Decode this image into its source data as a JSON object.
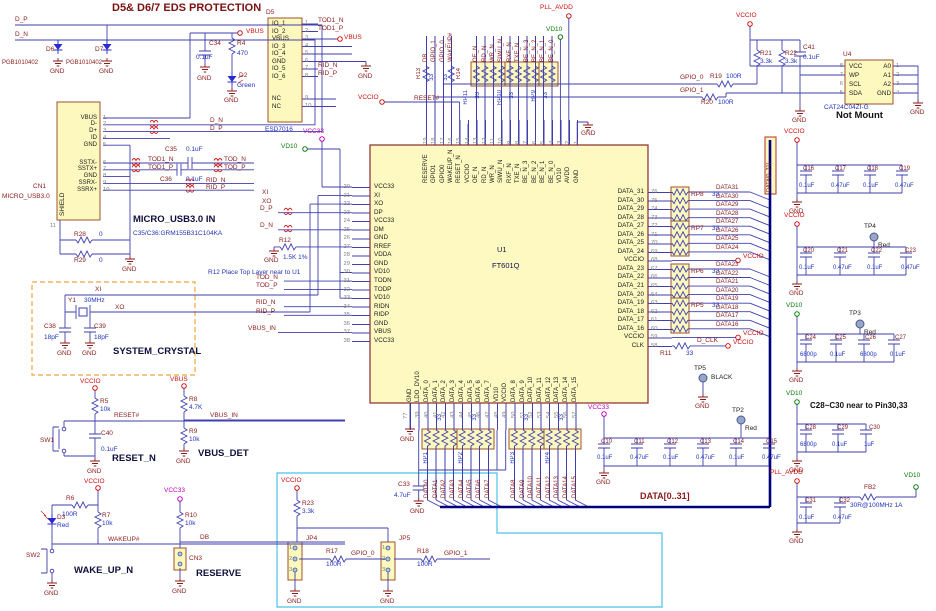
{
  "common": {
    "gnd": "GND",
    "vbus": "VBUS",
    "vccio": "VCCIO",
    "vcc33": "VCC33",
    "vd10": "VD10",
    "pll": "PLL_AVDD"
  },
  "esd": {
    "title": "D5& D6/7 EDS PROTECTION",
    "dp": "D_P",
    "dn": "D_N",
    "d6": "D6",
    "d7": "D7",
    "part": "PGB1010402",
    "c34": "C34",
    "c34v": "0.1uF",
    "r4": "R4",
    "r4v": "470",
    "d2": "D2",
    "d2v": "Green"
  },
  "d5": {
    "ref": "D5",
    "part": "ESD7016",
    "pins": [
      "IO_1",
      "IO_2",
      "VBUS",
      "IO_3",
      "IO_4",
      "GND",
      "IO_5",
      "IO_6"
    ],
    "nums": [
      "1",
      "2",
      "3",
      "4",
      "5",
      "6",
      "7",
      "8"
    ],
    "nc": [
      "NC",
      "NC"
    ],
    "ncnums": [
      "9",
      "10"
    ],
    "tod1n": "TOD1_N",
    "tod1p": "TOD1_P",
    "ridn": "RID_N",
    "ridp": "RID_P"
  },
  "usb": {
    "ref": "CN1",
    "name": "MICRO_USB3.0",
    "shield": "SHIELD",
    "shieldnum": "11",
    "pins1": [
      "VBUS",
      "D-",
      "D+",
      "ID",
      "GND"
    ],
    "nums1": [
      "1",
      "2",
      "3",
      "4",
      "5"
    ],
    "pins2": [
      "SSTX-",
      "SSTX+",
      "GND",
      "SSRX-",
      "SSRX+"
    ],
    "nums2": [
      "6",
      "7",
      "8",
      "9",
      "10"
    ],
    "dn": "D_N",
    "dp": "D_P",
    "tod1n": "TOD1_N",
    "tod1p": "TOD1_P",
    "todn": "TOD_N",
    "todp": "TOD_P",
    "ridn": "RID_N",
    "ridp": "RID_P",
    "c35": "C35",
    "c35v": "0.1uF",
    "c36": "C36",
    "c36v": "0.1uF",
    "r28": "R28",
    "r28v": "0",
    "r29": "R29",
    "r29v": "0",
    "title": "MICRO_USB3.0 IN",
    "note": "C35/C36:GRM155B31C104KA"
  },
  "xtal": {
    "xi": "XI",
    "xo": "XO",
    "y1": "Y1",
    "freq": "30MHz",
    "c38": "C38",
    "c38v": "18pF",
    "c39": "C39",
    "c39v": "18pF",
    "title": "SYSTEM_CRYSTAL"
  },
  "reset": {
    "r5": "R5",
    "r5v": "10k",
    "net": "RESET#",
    "sw": "SW1",
    "c40": "C40",
    "c40v": "0.1uF",
    "title": "RESET_N"
  },
  "vdet": {
    "r8": "R8",
    "r8v": "4.7K",
    "net": "VBUS_IN",
    "r9": "R9",
    "r9v": "10k",
    "title": "VBUS_DET"
  },
  "wake": {
    "r6": "R6",
    "r6v": "100R",
    "d3": "D3",
    "d3v": "Red",
    "r7": "R7",
    "r7v": "10k",
    "net": "WAKEUP#",
    "sw": "SW2",
    "title": "WAKE_UP_N"
  },
  "rsv": {
    "r10": "R10",
    "r10v": "10k",
    "net": "DB",
    "cn3": "CN3",
    "title": "RESERVE"
  },
  "jp": {
    "r23": "R23",
    "r23v": "3.3k",
    "jp4": "JP4",
    "r17": "R17",
    "r17v": "100R",
    "gpio0": "GPIO_0",
    "jp5": "JP5",
    "r18": "R18",
    "r18v": "100R",
    "gpio1": "GPIO_1",
    "nums": [
      "1",
      "2",
      "3"
    ]
  },
  "chip": {
    "ref": "U1",
    "part": "FT601Q",
    "left_pins": [
      "VCC33",
      "XI",
      "XO",
      "DP",
      "VCC33",
      "DM",
      "GND",
      "RREF",
      "VDDA",
      "GND",
      "VD10",
      "TODN",
      "TODP",
      "VD10",
      "RIDN",
      "RIDP",
      "GND",
      "VBUS",
      "VCC33"
    ],
    "left_nums": [
      "20",
      "21",
      "22",
      "23",
      "24",
      "25",
      "26",
      "27",
      "28",
      "29",
      "30",
      "31",
      "32",
      "33",
      "34",
      "35",
      "36",
      "37",
      "38"
    ],
    "right_pins": [
      "DATA_31",
      "DATA_30",
      "DATA_29",
      "DATA_28",
      "DATA_27",
      "DATA_26",
      "DATA_25",
      "DATA_24",
      "VCCIO",
      "DATA_23",
      "DATA_22",
      "DATA_21",
      "DATA_20",
      "DATA_19",
      "DATA_18",
      "DATA_17",
      "DATA_16",
      "VCCIO",
      "CLK"
    ],
    "right_nums": [
      "76",
      "75",
      "74",
      "73",
      "72",
      "71",
      "70",
      "69",
      "68",
      "67",
      "66",
      "65",
      "64",
      "63",
      "62",
      "61",
      "60",
      "59",
      "58"
    ],
    "top_pins": [
      "RESERVE",
      "GPIO1",
      "GPIO0",
      "WAKEUP_N",
      "RESET_N",
      "VCCIO",
      "OE_N",
      "RD_N",
      "WR_N",
      "SIWU_N",
      "RXF_N",
      "TXE_N",
      "BE_N_3",
      "BE_N_2",
      "BE_N_1",
      "BE_N_0",
      "VD10",
      "AVDD",
      "GND"
    ],
    "top_nums": [
      "19",
      "18",
      "17",
      "16",
      "15",
      "14",
      "13",
      "12",
      "11",
      "10",
      "9",
      "8",
      "7",
      "6",
      "5",
      "4",
      "3",
      "2",
      "1"
    ],
    "bottom_pins": [
      "GND",
      "LDO_DV10",
      "DATA_0",
      "DATA_1",
      "DATA_2",
      "DATA_3",
      "DATA_4",
      "DATA_5",
      "DATA_6",
      "DATA_7",
      "VD10",
      "VCCIO",
      "DATA_8",
      "DATA_9",
      "DATA_10",
      "DATA_11",
      "DATA_12",
      "DATA_13",
      "DATA_14",
      "DATA_15"
    ],
    "bottom_nums": [
      "39",
      "40",
      "41",
      "42",
      "43",
      "44",
      "45",
      "46",
      "47",
      "48",
      "49",
      "50",
      "51",
      "52",
      "53",
      "54",
      "55",
      "56",
      "57"
    ],
    "pad": "77"
  },
  "top": {
    "sigsa": [
      "DB",
      "GPIO_1",
      "GPIO_0",
      "WAKEUP#"
    ],
    "sigsb": [
      "OE_N",
      "RD_N",
      "WR_N",
      "SIWU_N",
      "RXF_N",
      "TXE_N",
      "BE_N_3",
      "BE_N_2",
      "BE_N_1",
      "BE_N_0"
    ],
    "r13": "R13",
    "r14": "R14",
    "v33": "33",
    "rp11": "RP11",
    "rp10": "RP10",
    "rp9": "RP9",
    "reset": "RESET#"
  },
  "left": {
    "xi": "XI",
    "xo": "XO",
    "dp": "D_P",
    "dn": "D_N",
    "r12": "R12",
    "r12v": "1.5K 1%",
    "note": "R12 Place Top Layer near to U1",
    "todn": "TOD_N",
    "todp": "TOD_P",
    "ridn": "RID_N",
    "ridp": "RID_P",
    "vbusin": "VBUS_IN"
  },
  "right": {
    "rp8": "RP8",
    "rp7": "RP7",
    "rp6": "RP6",
    "rp5": "RP5",
    "v33": "33",
    "hi": [
      "DATA31",
      "DATA30",
      "DATA29",
      "DATA28",
      "DATA27",
      "DATA26",
      "DATA25",
      "DATA24"
    ],
    "lo": [
      "DATA23",
      "DATA22",
      "DATA21",
      "DATA20",
      "DATA19",
      "DATA18",
      "DATA17",
      "DATA16"
    ],
    "r11": "R11",
    "r11v": "33",
    "dclk": "D_CLK",
    "bus": "DATA[0..31]"
  },
  "bot": {
    "rp1": "RP1",
    "rp2": "RP2",
    "rp3": "RP3",
    "rp4": "RP4",
    "v33": "33",
    "a": [
      "DATA0",
      "DATA1",
      "DATA2",
      "DATA3",
      "DATA4",
      "DATA5",
      "DATA6",
      "DATA7"
    ],
    "b": [
      "DATA8",
      "DATA9",
      "DATA10",
      "DATA11",
      "DATA12",
      "DATA13",
      "DATA14",
      "DATA15"
    ],
    "c33": "C33",
    "c33v": "4.7uF"
  },
  "banks": {
    "c10": {
      "refs": [
        "C10",
        "C11",
        "C12",
        "C13",
        "C14",
        "C15"
      ],
      "vals": [
        "0.1uF",
        "0.47uF",
        "0.1uF",
        "0.47uF",
        "0.1uF",
        "0.47uF"
      ]
    },
    "c16": {
      "refs": [
        "C16",
        "C17",
        "C18",
        "C19"
      ],
      "vals": [
        "0.1uF",
        "0.47uF",
        "0.1uF",
        "0.47uF"
      ]
    },
    "c20": {
      "refs": [
        "C20",
        "C21",
        "C22",
        "C23"
      ],
      "vals": [
        "0.1uF",
        "0.47uF",
        "0.1uF",
        "0.47uF"
      ]
    },
    "c24": {
      "refs": [
        "C24",
        "C25",
        "C26",
        "C27"
      ],
      "vals": [
        "6800p",
        "0.1uF",
        "6800p",
        "0.1uF"
      ]
    },
    "c28": {
      "refs": [
        "C28",
        "C29",
        "C30"
      ],
      "vals": [
        "6800p",
        "0.1uF",
        "1uF"
      ],
      "note": "C28~C30 near to Pin30,33"
    },
    "c31": {
      "refs": [
        "C31",
        "C32"
      ],
      "vals": [
        "0.1uF",
        "0.47uF"
      ]
    },
    "fb2": "FB2",
    "fb2v": "30R@100MHz 1A"
  },
  "tp": {
    "tp2": "TP2",
    "tp2c": "Red",
    "tp3": "TP3",
    "tp3c": "Red",
    "tp4": "TP4",
    "tp4c": "Red",
    "tp5": "TP5",
    "tp5c": "BLACK"
  },
  "ee": {
    "u4": "U4",
    "part": "CAT24C04ZI-G",
    "note": "Not Mount",
    "lp": [
      "VCC",
      "WP",
      "SCL",
      "SDA"
    ],
    "ln": [
      "8",
      "7",
      "6",
      "5"
    ],
    "rp": [
      "A0",
      "A1",
      "A2",
      "GND"
    ],
    "rn": [
      "1",
      "2",
      "3",
      "4"
    ],
    "r21": "R21",
    "r21v": "3.3k",
    "r22": "R22",
    "r22v": "3.3k",
    "c41": "C41",
    "c41v": "0.1uF",
    "gpio0": "GPIO_0",
    "gpio1": "GPIO_1",
    "r19": "R19",
    "r19v": "100R",
    "r20": "R20",
    "r20v": "100R"
  }
}
